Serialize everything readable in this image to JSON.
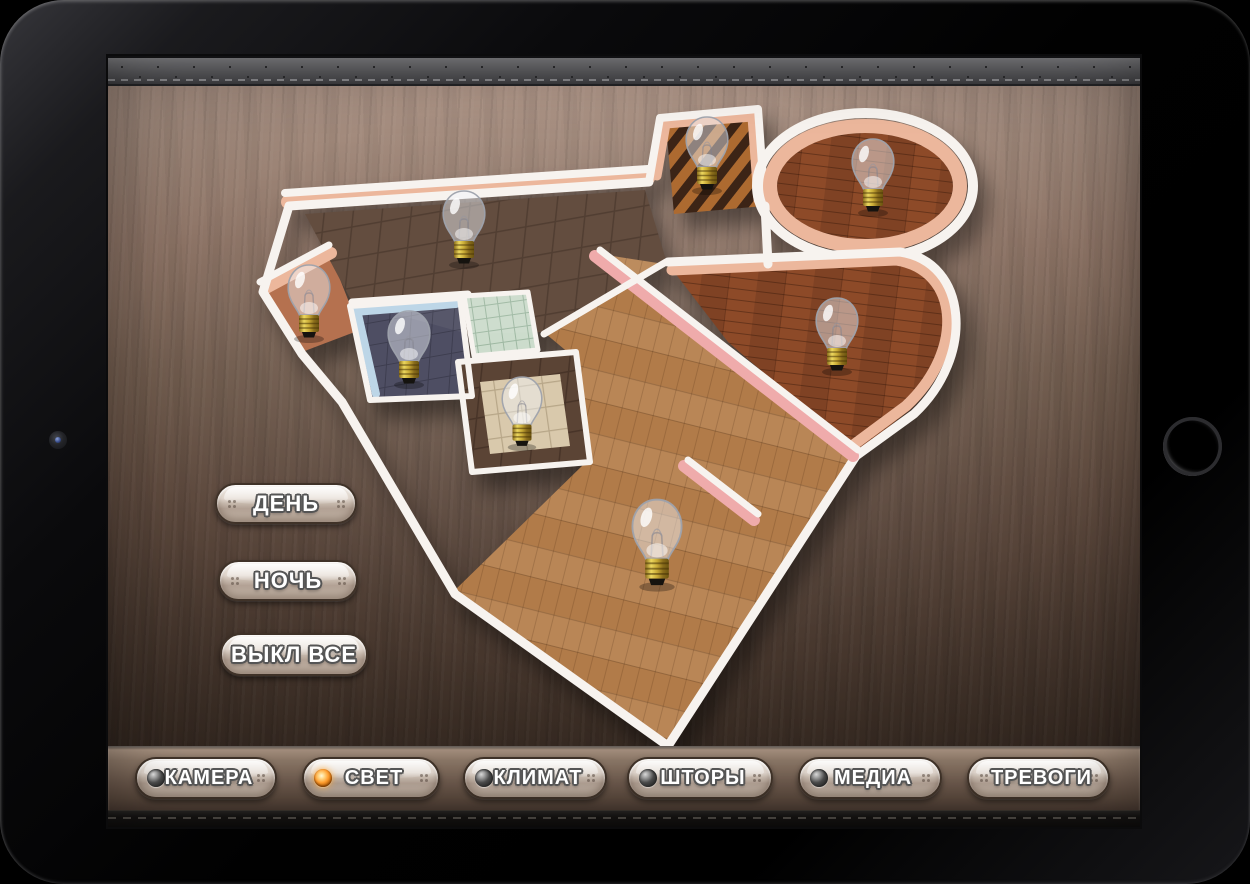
{
  "scene_buttons": {
    "items": [
      {
        "id": "day",
        "label": "ДЕНЬ"
      },
      {
        "id": "night",
        "label": "НОЧЬ"
      },
      {
        "id": "all_off",
        "label": "ВЫКЛ ВСЕ"
      }
    ]
  },
  "toolbar": {
    "items": [
      {
        "id": "camera",
        "label": "КАМЕРА",
        "led": "off",
        "active": false
      },
      {
        "id": "light",
        "label": "СВЕТ",
        "led": "on",
        "active": true
      },
      {
        "id": "climate",
        "label": "КЛИМАТ",
        "led": "off",
        "active": false
      },
      {
        "id": "curtains",
        "label": "ШТОРЫ",
        "led": "off",
        "active": false
      },
      {
        "id": "media",
        "label": "МЕДИА",
        "led": "off",
        "active": false
      },
      {
        "id": "alarms",
        "label": "ТРЕВОГИ",
        "led": "none",
        "active": false
      }
    ]
  },
  "colors": {
    "led_on": "#ff9d2e",
    "led_off": "#4a4a4a",
    "button_face": "#d9cdc2",
    "background_wood_top": "#b59b8d",
    "background_wood_bottom": "#342720"
  },
  "floorplan": {
    "walls": {
      "white": "#f7f3ef",
      "peach": "#ecb79c",
      "pink": "#efabab",
      "blue_tile": "#bdd6e7"
    },
    "rooms": {
      "kitchen_dining": {
        "floor": "#5b4435"
      },
      "corridor": {
        "floor_light": "#ad6a30",
        "floor_dark": "#3c2416"
      },
      "lounge": {
        "floor": "#8d4a28"
      },
      "bedroom": {
        "floor": "#8d4a28"
      },
      "living_room": {
        "floor": "#b17b49"
      },
      "hallway": {
        "floor_tile": "#5b4435",
        "floor_inset": "#d9c9ac"
      },
      "bathroom": {
        "floor": "#4e4e63"
      },
      "shower": {
        "floor": "#ccdccc"
      },
      "storage": {
        "floor": "#b5714f"
      }
    },
    "lights": [
      {
        "room": "corridor",
        "x": 599,
        "y": 102,
        "state": "off",
        "scale": 1
      },
      {
        "room": "lounge",
        "x": 765,
        "y": 124,
        "state": "off",
        "scale": 1
      },
      {
        "room": "kitchen_dining",
        "x": 356,
        "y": 176,
        "state": "off",
        "scale": 1
      },
      {
        "room": "storage",
        "x": 201,
        "y": 250,
        "state": "off",
        "scale": 1
      },
      {
        "room": "bathroom",
        "x": 301,
        "y": 296,
        "state": "off",
        "scale": 1
      },
      {
        "room": "hallway",
        "x": 414,
        "y": 360,
        "state": "off",
        "scale": 0.95
      },
      {
        "room": "bedroom",
        "x": 729,
        "y": 283,
        "state": "off",
        "scale": 1
      },
      {
        "room": "living_room",
        "x": 549,
        "y": 492,
        "state": "off",
        "scale": 1.18
      }
    ]
  }
}
